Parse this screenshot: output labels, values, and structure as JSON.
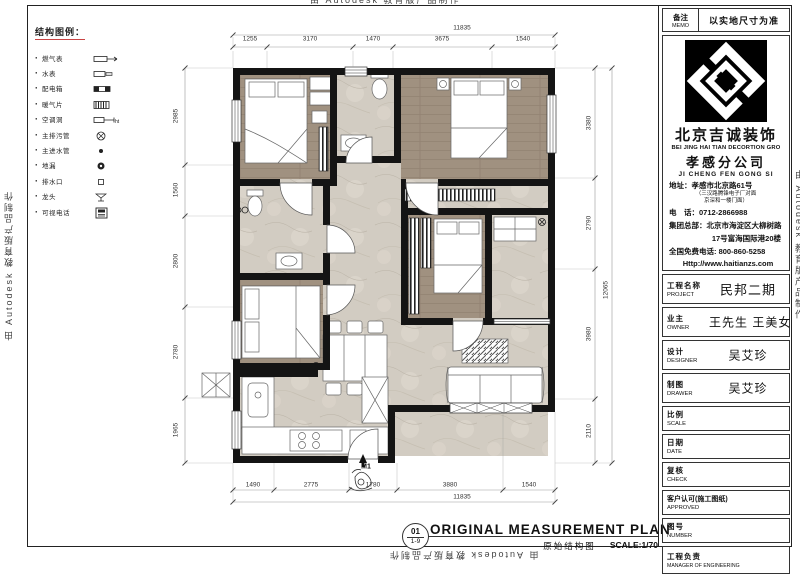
{
  "watermark": {
    "text": "由 Autodesk 教育版产品制作"
  },
  "legend": {
    "title": "结构图例",
    "colon": "：",
    "items": [
      {
        "label": "燃气表",
        "icon": "gas-meter-icon"
      },
      {
        "label": "水表",
        "icon": "water-meter-icon"
      },
      {
        "label": "配电箱",
        "icon": "distribution-box-icon"
      },
      {
        "label": "暖气片",
        "icon": "radiator-icon"
      },
      {
        "label": "空调洞",
        "icon": "ac-hole-icon"
      },
      {
        "label": "主排污管",
        "icon": "main-sewage-pipe-icon"
      },
      {
        "label": "主进水管",
        "icon": "main-water-pipe-icon"
      },
      {
        "label": "地漏",
        "icon": "floor-drain-icon"
      },
      {
        "label": "排水口",
        "icon": "drain-outlet-icon"
      },
      {
        "label": "龙头",
        "icon": "faucet-icon"
      },
      {
        "label": "可视电话",
        "icon": "videophone-icon"
      }
    ]
  },
  "plan": {
    "entry_label": "M1",
    "dims": {
      "top": {
        "overall": "11835",
        "segments": [
          "1255",
          "3170",
          "1470",
          "3675",
          "1540"
        ]
      },
      "bottom": {
        "overall": "11835",
        "segments": [
          "1490",
          "2775",
          "1780",
          "3880",
          "1540"
        ]
      },
      "left": {
        "segments": [
          "2985",
          "1560",
          "2800",
          "2780",
          "1965"
        ]
      },
      "right": {
        "overall": "12065",
        "segments": [
          "3380",
          "2790",
          "3980",
          "2110"
        ]
      }
    }
  },
  "titlebar": {
    "sheet_no": "01",
    "sheet_index": "1-9",
    "title_en": "ORIGINAL MEASUREMENT PLAN",
    "title_cn": "原始结构图",
    "scale": "SCALE:1/70"
  },
  "titleblock": {
    "memo_cn": "备注",
    "memo_en": "MEMO",
    "memo_value": "以实地尺寸为准",
    "company_cn": "北京吉诚装饰",
    "company_en": "BEI JING HAI TIAN DECORTION GRO",
    "branch_cn": "孝感分公司",
    "branch_py": "JI CHENG FEN GONG SI",
    "address_label": "地址：",
    "address": "孝感市北京路61号",
    "address_note1": "（三汉路腾锋电子厂对面",
    "address_note2": "京深和一楼门面）",
    "phone_label": "电　话：",
    "phone": "0712-2866988",
    "hq_label": "集团总部：",
    "hq1": "北京市海淀区大柳树路",
    "hq2": "17号富海国际港20楼",
    "hotline_label": "全国免费电话:",
    "hotline": "800-860-5258",
    "website": "Http://www.haitianzs.com",
    "rows": [
      {
        "cn": "工程名称",
        "en": "PROJECT",
        "value": "民邦二期"
      },
      {
        "cn": "业主",
        "en": "OWNER",
        "value": "王先生 王美女"
      },
      {
        "cn": "设计",
        "en": "DESIGNER",
        "value": "吴艾珍"
      },
      {
        "cn": "制图",
        "en": "DRAWER",
        "value": "吴艾珍"
      },
      {
        "cn": "比例",
        "en": "SCALE",
        "value": ""
      },
      {
        "cn": "日期",
        "en": "DATE",
        "value": ""
      },
      {
        "cn": "复核",
        "en": "CHECK",
        "value": ""
      },
      {
        "cn": "客户认可(施工图纸)",
        "en": "APPROVED",
        "value": ""
      },
      {
        "cn": "图号",
        "en": "NUMBER",
        "value": ""
      },
      {
        "cn": "工程负责",
        "en": "MANAGER OF ENGINEERING",
        "value": ""
      }
    ]
  }
}
